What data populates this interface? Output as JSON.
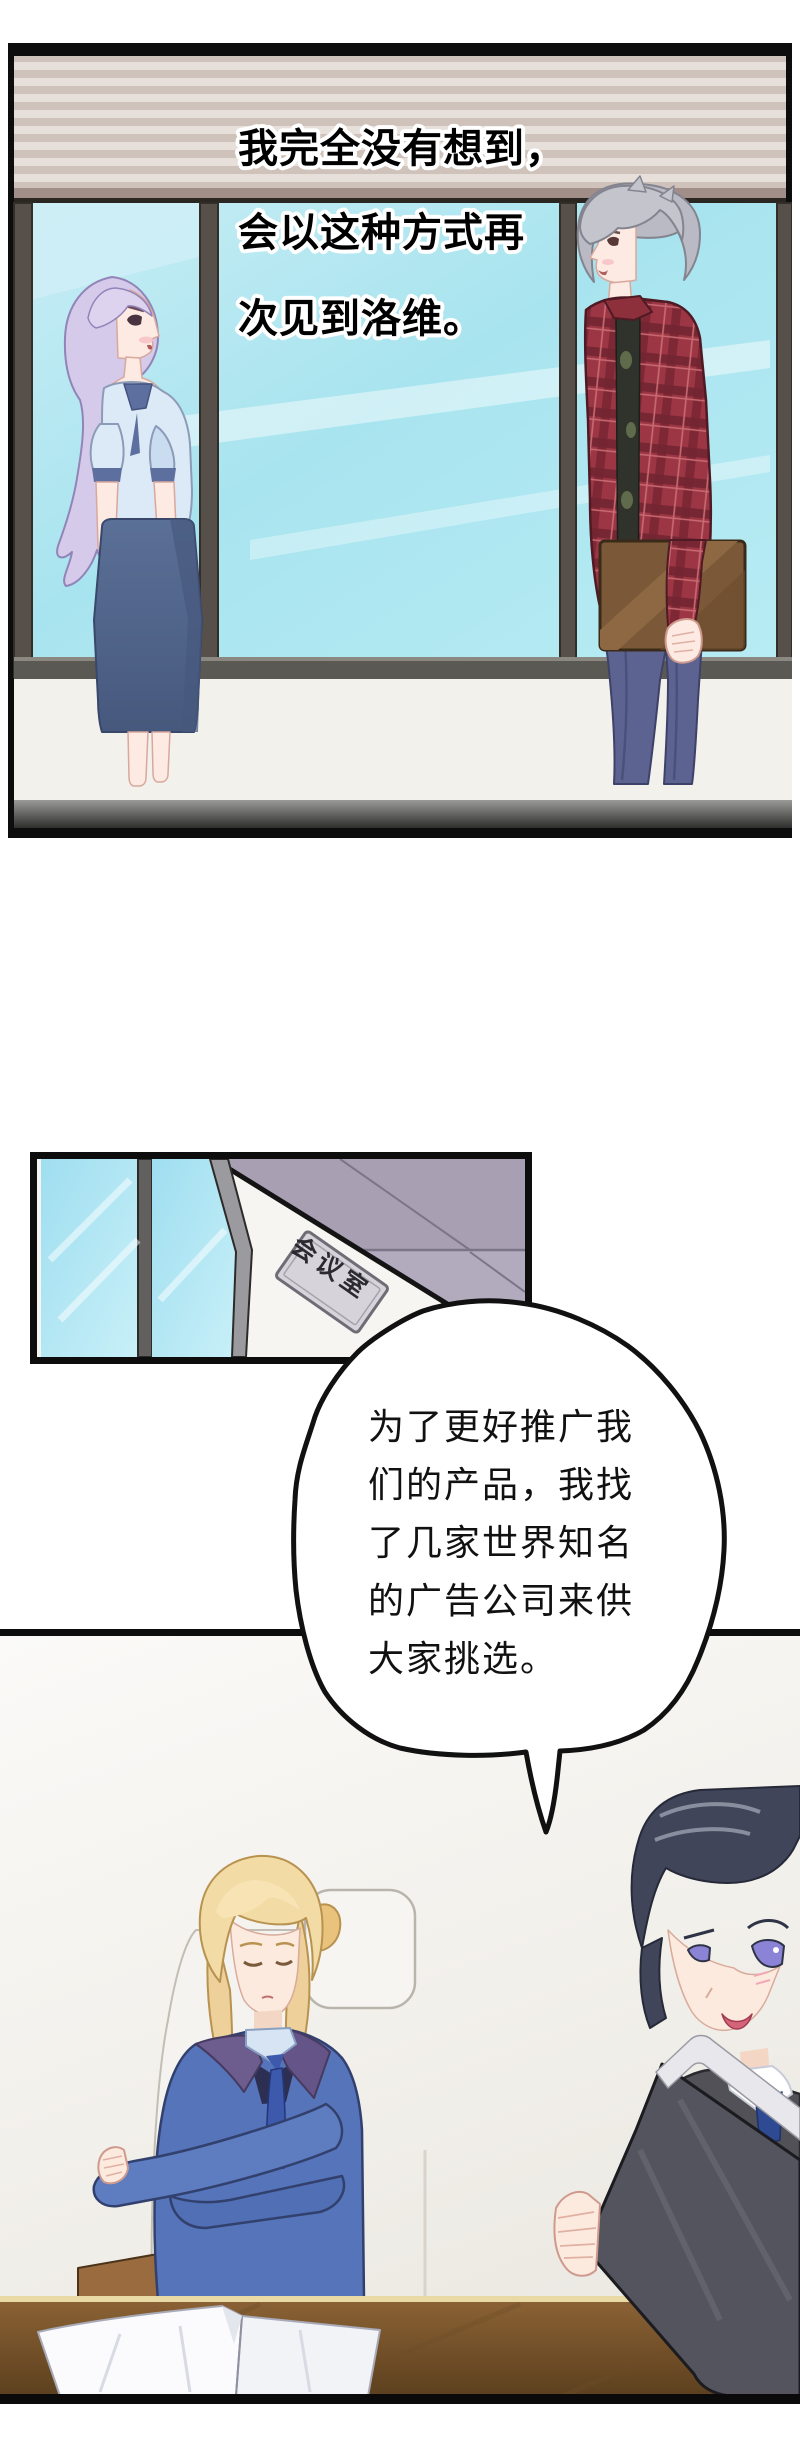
{
  "page": {
    "width": 800,
    "height": 2459,
    "background": "#ffffff",
    "type": "manga-page",
    "panel_count": 3
  },
  "panel1": {
    "narration_lines": [
      "我完全没有想到，",
      "会以这种方式再",
      "次见到洛维。"
    ]
  },
  "panel2": {
    "door_sign": "会议室"
  },
  "speech_bubble": {
    "lines": [
      "为了更好推广我",
      "们的产品，我找",
      "了几家世界知名",
      "的广告公司来供",
      "大家挑选。"
    ]
  },
  "colors": {
    "narration_text": "#000000",
    "narration_outline": "#ffffff",
    "bubble_fill": "#ffffff",
    "bubble_stroke": "#111111",
    "sky": "#a8e4ef",
    "awning_light": "#e7e0da",
    "awning_dark": "#cec2ba",
    "window_frame": "#57504a",
    "panel_border": "#0d0d0d",
    "ceiling": "#a8a0b2",
    "glass": "#9fdef0",
    "plaque_fill": "#d6d3db",
    "woman_hair": "#d5cae9",
    "woman_blouse": "#dce9f6",
    "woman_skirt": "#55698f",
    "man_hair": "#b9bac3",
    "man_plaid_shirt": "#9c3644",
    "man_pants": "#5d6391",
    "briefcase": "#7d5b3a",
    "blonde_hair": "#f3dba6",
    "blue_suit": "#5674b9",
    "dark_suit": "#515157",
    "folder": "#54545e",
    "desk_wood": "#7a5631",
    "floor": "#6e6e6c"
  }
}
